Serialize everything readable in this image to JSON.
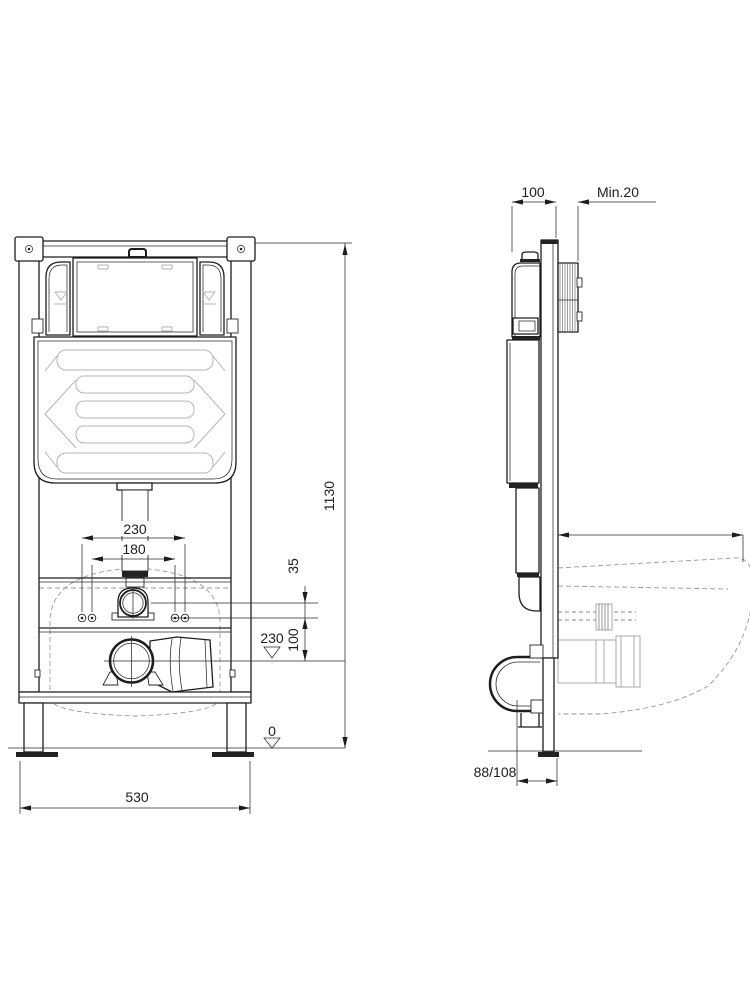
{
  "colors": {
    "line": "#1d1d1d",
    "light_detail": "#b5b5b5",
    "dashed_reference": "#9a9a9a",
    "background": "#ffffff"
  },
  "front_view": {
    "height": "1130",
    "width": "530",
    "rod_spacing_outer": "230",
    "rod_spacing_inner": "180",
    "flush_to_rods": "35",
    "rods_to_drain": "100",
    "drain_level": "230",
    "floor_level": "0"
  },
  "side_view": {
    "frame_depth": "100",
    "wall_clearance": "Min.20",
    "drain_setback": "88/108"
  }
}
